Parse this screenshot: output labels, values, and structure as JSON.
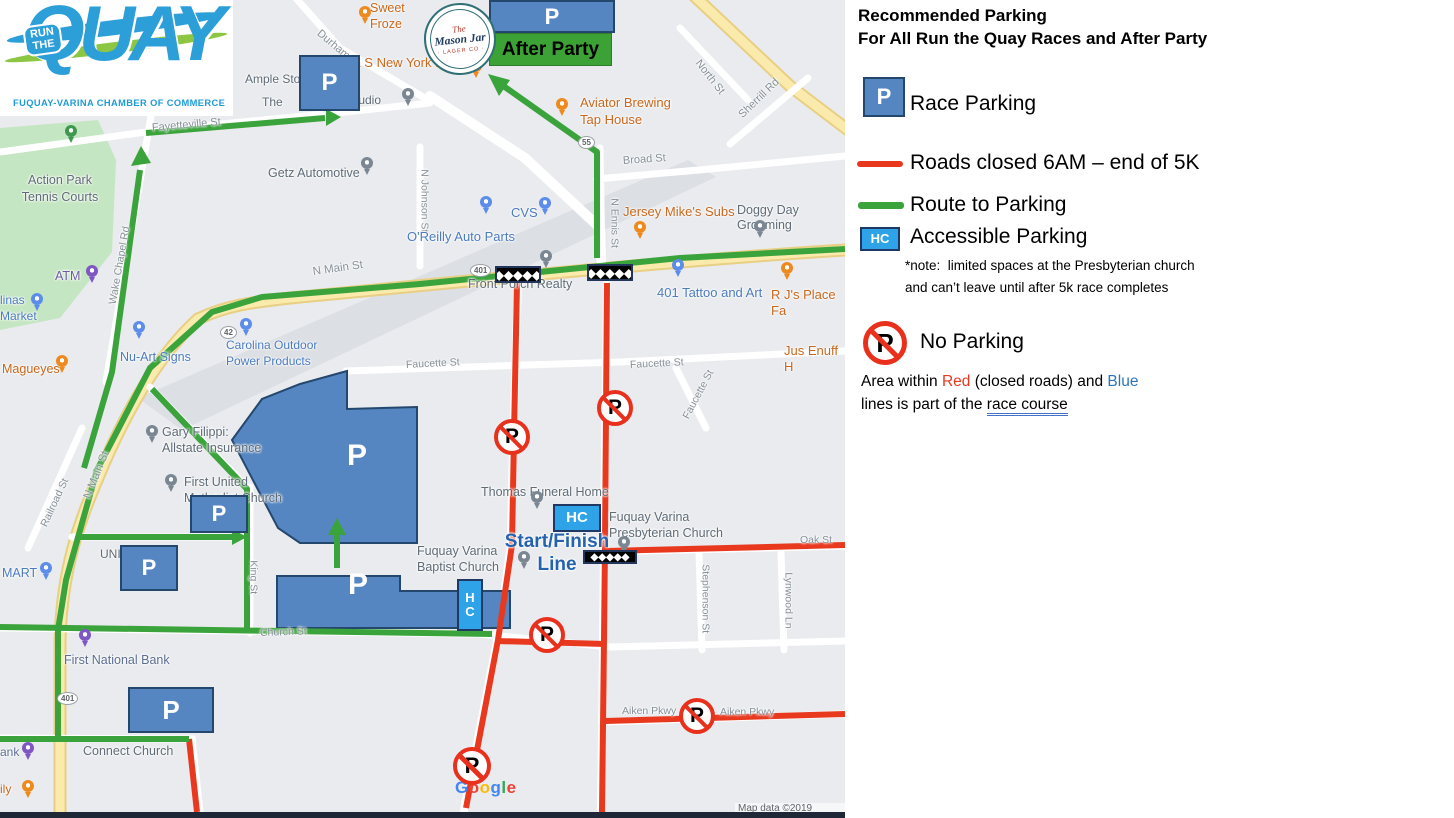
{
  "colors": {
    "road_closed": "#E8391F",
    "route_green": "#3BA33B",
    "race_course_blue": "#2F5496",
    "parking_fill": "#5586C1",
    "parking_border": "#24476E",
    "accessible_fill": "#2EA3E8",
    "start_finish_text": "#2563AE",
    "after_party_green": "#3DA235"
  },
  "logo": {
    "run_the": "RUN\nTHE",
    "quay": "QUAY",
    "subtitle": "FUQUAY-VARINA CHAMBER OF COMMERCE"
  },
  "mason_jar": {
    "the": "The",
    "name": "Mason Jar",
    "sub": "· LAGER CO ·"
  },
  "after_party": {
    "label": "After Party",
    "x": 489,
    "y": 33,
    "w": 123,
    "h": 33
  },
  "p_label": "P",
  "hc_label": "HC",
  "flag_glyphs": "◆◆◆◆◆",
  "google_logo": [
    [
      "G",
      "#4285F4"
    ],
    [
      "o",
      "#EA4335"
    ],
    [
      "o",
      "#FBBC05"
    ],
    [
      "g",
      "#4285F4"
    ],
    [
      "l",
      "#34A853"
    ],
    [
      "e",
      "#EA4335"
    ]
  ],
  "attribution": "Map data ©2019 Google",
  "legend": {
    "title1": "Recommended Parking",
    "title2": "For All Run the Quay Races and After Party",
    "race_parking": "Race Parking",
    "roads_closed": "Roads closed 6AM – end of 5K",
    "route_to_parking": "Route to Parking",
    "accessible_parking": "Accessible Parking",
    "note1": "*note:  limited spaces at the Presbyterian church",
    "note2": "and can’t leave until after 5k race completes",
    "no_parking": "No Parking",
    "area_pre": "Area within ",
    "area_red": "Red",
    "area_mid": " (closed roads) and ",
    "area_blue": "Blue",
    "area2_pre": "lines is part of the ",
    "area2_course": "race course"
  },
  "main_map": {
    "labels": [
      {
        "t": "Durham St",
        "x": 318,
        "y": 26,
        "s": 11,
        "c": "#869099",
        "r": 40
      },
      {
        "t": "Fayetteville St",
        "x": 152,
        "y": 122,
        "s": 11,
        "c": "#869099",
        "r": -5
      },
      {
        "t": "North St",
        "x": 697,
        "y": 55,
        "s": 11,
        "c": "#869099",
        "r": 52
      },
      {
        "t": "Sherrill Rd",
        "x": 741,
        "y": 110,
        "s": 11,
        "c": "#869099",
        "r": -44
      },
      {
        "t": "Broad St",
        "x": 623,
        "y": 155,
        "s": 11,
        "c": "#869099",
        "r": -4
      },
      {
        "t": "N Johnson St",
        "x": 424,
        "y": 163,
        "s": 10.5,
        "c": "#869099",
        "r": 90
      },
      {
        "t": "N Ennis St",
        "x": 614,
        "y": 192,
        "s": 10.5,
        "c": "#869099",
        "r": 90
      },
      {
        "t": "N Main St",
        "x": 313,
        "y": 266,
        "s": 11.5,
        "c": "#869099",
        "r": -8
      },
      {
        "t": "N Main St",
        "x": 88,
        "y": 492,
        "s": 11.5,
        "c": "#869099",
        "r": -68
      },
      {
        "t": "Wake Chapel Rd",
        "x": 113,
        "y": 298,
        "s": 10.5,
        "c": "#869099",
        "r": -80
      },
      {
        "t": "Railroad St",
        "x": 44,
        "y": 520,
        "s": 10.5,
        "c": "#869099",
        "r": -65
      },
      {
        "t": "Faucette St",
        "x": 406,
        "y": 359,
        "s": 10.5,
        "c": "#869099",
        "r": -3
      },
      {
        "t": "Faucette St",
        "x": 630,
        "y": 359,
        "s": 10.5,
        "c": "#869099",
        "r": -3
      },
      {
        "t": "Faucette St",
        "x": 686,
        "y": 412,
        "s": 10.5,
        "c": "#869099",
        "r": -62
      },
      {
        "t": "King St",
        "x": 253,
        "y": 554,
        "s": 10.5,
        "c": "#869099",
        "r": 90
      },
      {
        "t": "Church St",
        "x": 260,
        "y": 627,
        "s": 10.5,
        "c": "#869099",
        "r": -2
      },
      {
        "t": "Oak St",
        "x": 800,
        "y": 534,
        "s": 10.5,
        "c": "#869099"
      },
      {
        "t": "Stephenson St",
        "x": 705,
        "y": 558,
        "s": 10.5,
        "c": "#869099",
        "r": 90
      },
      {
        "t": "Lynwood Ln",
        "x": 788,
        "y": 566,
        "s": 10.5,
        "c": "#869099",
        "r": 90
      },
      {
        "t": "Aiken Pkwy",
        "x": 622,
        "y": 705,
        "s": 10.5,
        "c": "#869099"
      },
      {
        "t": "Aiken Pkwy",
        "x": 720,
        "y": 706,
        "s": 10.5,
        "c": "#869099"
      },
      {
        "t": "Sweet\nFroze",
        "x": 370,
        "y": 1,
        "s": 12.5,
        "c": "#C9671D",
        "lh": 1.25
      },
      {
        "t": "& S New York Pizza",
        "x": 352,
        "y": 55,
        "s": 13,
        "c": "#C9671D"
      },
      {
        "t": "Ample Storage",
        "x": 245,
        "y": 72,
        "s": 12,
        "c": "#5F6B76"
      },
      {
        "t": "The",
        "x": 262,
        "y": 95,
        "s": 12,
        "c": "#5F6B76"
      },
      {
        "t": "Studio",
        "x": 347,
        "y": 93,
        "s": 12,
        "c": "#5F6B76"
      },
      {
        "t": "Aviator Brewing\nTap House",
        "x": 580,
        "y": 95,
        "s": 13,
        "c": "#C9671D",
        "lh": 1.3
      },
      {
        "t": "Getz Automotive",
        "x": 268,
        "y": 166,
        "s": 12.5,
        "c": "#5F6B76"
      },
      {
        "t": "Action Park\nTennis Courts",
        "x": 60,
        "y": 172,
        "s": 12.5,
        "c": "#5F6B76",
        "a": "c",
        "lh": 1.35
      },
      {
        "t": "ATM",
        "x": 55,
        "y": 269,
        "s": 12.5,
        "c": "#6F5BA7"
      },
      {
        "t": "linas\nMarket",
        "x": 0,
        "y": 293,
        "s": 12,
        "c": "#4C7BC0",
        "lh": 1.3
      },
      {
        "t": "Magueyes",
        "x": 2,
        "y": 362,
        "s": 12.5,
        "c": "#C9671D"
      },
      {
        "t": "Nu-Art Signs",
        "x": 120,
        "y": 350,
        "s": 12.5,
        "c": "#4C7BC0"
      },
      {
        "t": "Carolina Outdoor\nPower Products",
        "x": 226,
        "y": 338,
        "s": 12,
        "c": "#4C7BC0",
        "lh": 1.3
      },
      {
        "t": "O'Reilly Auto Parts",
        "x": 407,
        "y": 229,
        "s": 13,
        "c": "#4C7BC0"
      },
      {
        "t": "CVS",
        "x": 511,
        "y": 205,
        "s": 13,
        "c": "#4C7BC0"
      },
      {
        "t": "Jersey Mike's Subs",
        "x": 623,
        "y": 204,
        "s": 13,
        "c": "#C9671D"
      },
      {
        "t": "Doggy Day Grooming",
        "x": 737,
        "y": 203,
        "s": 12.5,
        "c": "#5F6B76"
      },
      {
        "t": "401 Tattoo and Art",
        "x": 657,
        "y": 285,
        "s": 13,
        "c": "#4C7BC0"
      },
      {
        "t": "R J's Place Fa",
        "x": 771,
        "y": 287,
        "s": 13,
        "c": "#C9671D"
      },
      {
        "t": "Jus Enuff H",
        "x": 784,
        "y": 343,
        "s": 13,
        "c": "#C9671D"
      },
      {
        "t": "Front Porch Realty",
        "x": 468,
        "y": 277,
        "s": 12.5,
        "c": "#5F6B76"
      },
      {
        "t": "Gary Filippi:\nAllstate Insurance",
        "x": 162,
        "y": 424,
        "s": 12.5,
        "c": "#5F6B76",
        "lh": 1.3
      },
      {
        "t": "First United\nMethodist Church",
        "x": 184,
        "y": 474,
        "s": 12.5,
        "c": "#5F6B76",
        "lh": 1.3
      },
      {
        "t": "UNI",
        "x": 100,
        "y": 547,
        "s": 12,
        "c": "#5F6B76"
      },
      {
        "t": "MART",
        "x": 2,
        "y": 566,
        "s": 12.5,
        "c": "#4C7BC0"
      },
      {
        "t": "First National Bank",
        "x": 64,
        "y": 653,
        "s": 12.5,
        "c": "#5E6E92"
      },
      {
        "t": "Connect Church",
        "x": 83,
        "y": 744,
        "s": 12.5,
        "c": "#5F6B76"
      },
      {
        "t": "ank",
        "x": 0,
        "y": 745,
        "s": 12,
        "c": "#5E6E92"
      },
      {
        "t": "ily",
        "x": 0,
        "y": 782,
        "s": 12,
        "c": "#C9671D"
      },
      {
        "t": "Thomas Funeral Home",
        "x": 481,
        "y": 485,
        "s": 12.5,
        "c": "#5F6B76"
      },
      {
        "t": "Fuquay Varina\nPresbyterian Church",
        "x": 609,
        "y": 509,
        "s": 12.5,
        "c": "#5F6B76",
        "lh": 1.3
      },
      {
        "t": "Fuquay Varina\nBaptist Church",
        "x": 417,
        "y": 543,
        "s": 12.5,
        "c": "#5F6B76",
        "lh": 1.3
      },
      {
        "t": "Start/Finish\nLine",
        "x": 557,
        "y": 531,
        "s": 19,
        "c": "#2563AE",
        "a": "c",
        "b": 1,
        "lh": 1.2
      }
    ],
    "pins": [
      [
        365,
        12,
        "#EE8A1D"
      ],
      [
        476,
        66,
        "#EE8A1D"
      ],
      [
        562,
        104,
        "#EE8A1D"
      ],
      [
        640,
        227,
        "#EE8A1D"
      ],
      [
        62,
        361,
        "#EE8A1D"
      ],
      [
        787,
        268,
        "#EE8A1D"
      ],
      [
        28,
        786,
        "#EE8A1D"
      ],
      [
        408,
        94,
        "#7A8793"
      ],
      [
        367,
        163,
        "#7A8793"
      ],
      [
        760,
        226,
        "#7A8793"
      ],
      [
        546,
        256,
        "#7A8793"
      ],
      [
        537,
        497,
        "#7A8793"
      ],
      [
        152,
        431,
        "#7A8793"
      ],
      [
        171,
        480,
        "#7A8793"
      ],
      [
        624,
        542,
        "#7A8793"
      ],
      [
        524,
        557,
        "#7A8793"
      ],
      [
        71,
        131,
        "#3E9850"
      ],
      [
        92,
        271,
        "#7E57C2"
      ],
      [
        85,
        635,
        "#7E57C2"
      ],
      [
        28,
        748,
        "#7E57C2"
      ],
      [
        486,
        202,
        "#5C8DEB"
      ],
      [
        545,
        203,
        "#5C8DEB"
      ],
      [
        139,
        327,
        "#5C8DEB"
      ],
      [
        246,
        324,
        "#5C8DEB"
      ],
      [
        678,
        265,
        "#5C8DEB"
      ],
      [
        46,
        568,
        "#5C8DEB"
      ],
      [
        37,
        299,
        "#5C8DEB"
      ]
    ],
    "p_boxes": [
      [
        489,
        0,
        126,
        33,
        22
      ],
      [
        299,
        55,
        61,
        56,
        24
      ],
      [
        190,
        495,
        58,
        38,
        22
      ],
      [
        120,
        545,
        58,
        46,
        22
      ],
      [
        128,
        687,
        86,
        46,
        26
      ]
    ],
    "poly_p": [
      [
        357,
        456,
        30
      ],
      [
        358,
        585,
        30
      ]
    ],
    "hc_boxes": [
      [
        553,
        504,
        48,
        28,
        15,
        0
      ],
      [
        457,
        579,
        26,
        52,
        13,
        1
      ]
    ],
    "flags": [
      [
        495,
        266,
        46,
        17
      ],
      [
        587,
        264,
        46,
        17
      ],
      [
        583,
        550,
        54,
        14
      ]
    ],
    "no_parking": [
      [
        512,
        437,
        36
      ],
      [
        615,
        408,
        36
      ],
      [
        547,
        635,
        36
      ],
      [
        697,
        716,
        36
      ],
      [
        472,
        766,
        38
      ]
    ],
    "shields": [
      {
        "t": "401",
        "x": 470,
        "y": 264
      },
      {
        "t": "55",
        "x": 578,
        "y": 136
      },
      {
        "t": "42",
        "x": 220,
        "y": 326
      },
      {
        "t": "401",
        "x": 57,
        "y": 692
      }
    ]
  },
  "inset_map": {
    "origin": [
      860,
      470
    ],
    "labels": [
      {
        "t": "Start/Finish\nLine",
        "x": 997,
        "y": 488,
        "s": 15,
        "c": "#2563AE",
        "a": "c",
        "b": 1,
        "lh": 1.25
      },
      {
        "t": "GI Guy",
        "x": 1334,
        "y": 480,
        "s": 8,
        "c": "#C0392B"
      },
      {
        "t": "United States\nPostal Service",
        "x": 1306,
        "y": 509,
        "s": 8.5,
        "c": "#5F6B76",
        "lh": 1.25
      },
      {
        "t": "Sou",
        "x": 1404,
        "y": 538,
        "s": 8.5,
        "c": "#5F6B76"
      },
      {
        "t": "Fuquay-Varina\nMiddle School",
        "x": 873,
        "y": 577,
        "s": 8.5,
        "c": "#5F6B76",
        "lh": 1.25
      },
      {
        "t": "Falcon Park\nCouncil Gym",
        "x": 964,
        "y": 603,
        "s": 8.5,
        "c": "#437046",
        "lh": 1.25
      },
      {
        "t": "Snapp Philip L",
        "x": 1182,
        "y": 604,
        "s": 8.5,
        "c": "#5F6B76"
      },
      {
        "t": "0.8 miles to\nStart/Finish line",
        "x": 1287,
        "y": 616,
        "s": 16.5,
        "c": "#111111",
        "a": "c",
        "lh": 1.3
      },
      {
        "t": "Caro-Line Holding",
        "x": 945,
        "y": 659,
        "s": 8.5,
        "c": "#5F6B76"
      },
      {
        "t": "International\nFood Market",
        "x": 986,
        "y": 696,
        "s": 8.5,
        "c": "#5F6B76",
        "lh": 1.25
      },
      {
        "t": "Fuquay Varina United\nMethodist Church",
        "x": 1232,
        "y": 700,
        "s": 8.5,
        "c": "#5F6B76",
        "lh": 1.25
      }
    ],
    "pins": [
      [
        1347,
        470,
        "#D93025",
        9
      ],
      [
        1352,
        516,
        "#7A8793",
        9
      ],
      [
        917,
        583,
        "#7A8793",
        9
      ],
      [
        961,
        616,
        "#3E9850",
        9
      ],
      [
        1196,
        620,
        "#7A8793",
        9
      ],
      [
        938,
        661,
        "#5C8DEB",
        9
      ],
      [
        1008,
        719,
        "#7A8793",
        9
      ],
      [
        1299,
        707,
        "#7A8793",
        9
      ]
    ],
    "p_boxes": [
      [
        1272,
        670,
        51,
        32,
        17,
        -5
      ],
      [
        1256,
        744,
        72,
        39,
        20,
        0
      ]
    ],
    "poly_p": [],
    "hc_boxes": [],
    "flags": [
      [
        921,
        476,
        53,
        13
      ]
    ],
    "no_parking": [
      [
        913,
        496,
        29
      ],
      [
        884,
        563,
        27
      ],
      [
        949,
        566,
        29
      ],
      [
        1041,
        530,
        28
      ],
      [
        922,
        652,
        28
      ],
      [
        901,
        730,
        28
      ]
    ],
    "shields": []
  }
}
